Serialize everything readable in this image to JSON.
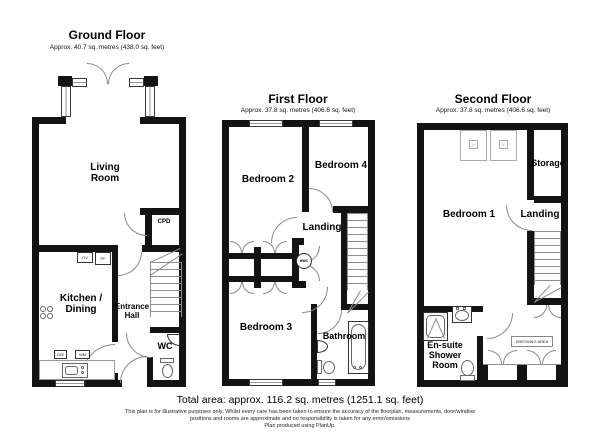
{
  "floors": {
    "ground": {
      "title": "Ground Floor",
      "area": "Approx. 40.7 sq. metres (438.0 sq. feet)",
      "rooms": {
        "living_room": "Living Room",
        "cupboard": "CPD",
        "kitchen_dining": "Kitchen / Dining",
        "entrance_hall": "Entrance Hall",
        "wc": "WC"
      },
      "appliances": {
        "oven": "OV",
        "fridge_freezer": "FF",
        "dishwasher": "DW",
        "washing_machine": "WM"
      }
    },
    "first": {
      "title": "First Floor",
      "area": "Approx. 37.8 sq. metres (406.6 sq. feet)",
      "rooms": {
        "bedroom_2": "Bedroom 2",
        "bedroom_4": "Bedroom 4",
        "landing": "Landing",
        "bedroom_3": "Bedroom 3",
        "bathroom": "Bathroom"
      },
      "appliances": {
        "hot_water_cylinder": "HWC"
      }
    },
    "second": {
      "title": "Second Floor",
      "area": "Approx. 37.8 sq. metres (406.6 sq. feet)",
      "rooms": {
        "bedroom_1": "Bedroom 1",
        "storage": "Storage",
        "landing": "Landing",
        "ensuite": "En-suite Shower Room",
        "dressing_area": "DRESSING AREA"
      },
      "skylight_label": "V"
    }
  },
  "footer": {
    "total_area": "Total area: approx. 116.2 sq. metres (1251.1 sq. feet)",
    "disclaimer_line1": "This plan is for illustrative purposes only. Whilst every care has been taken to ensure the accuracy of the floorplan, measurements, door/window",
    "disclaimer_line2": "positions and rooms are approximate and no responsibility is taken for any error/omissions",
    "produced_by": "Plan produced using PlanUp."
  }
}
